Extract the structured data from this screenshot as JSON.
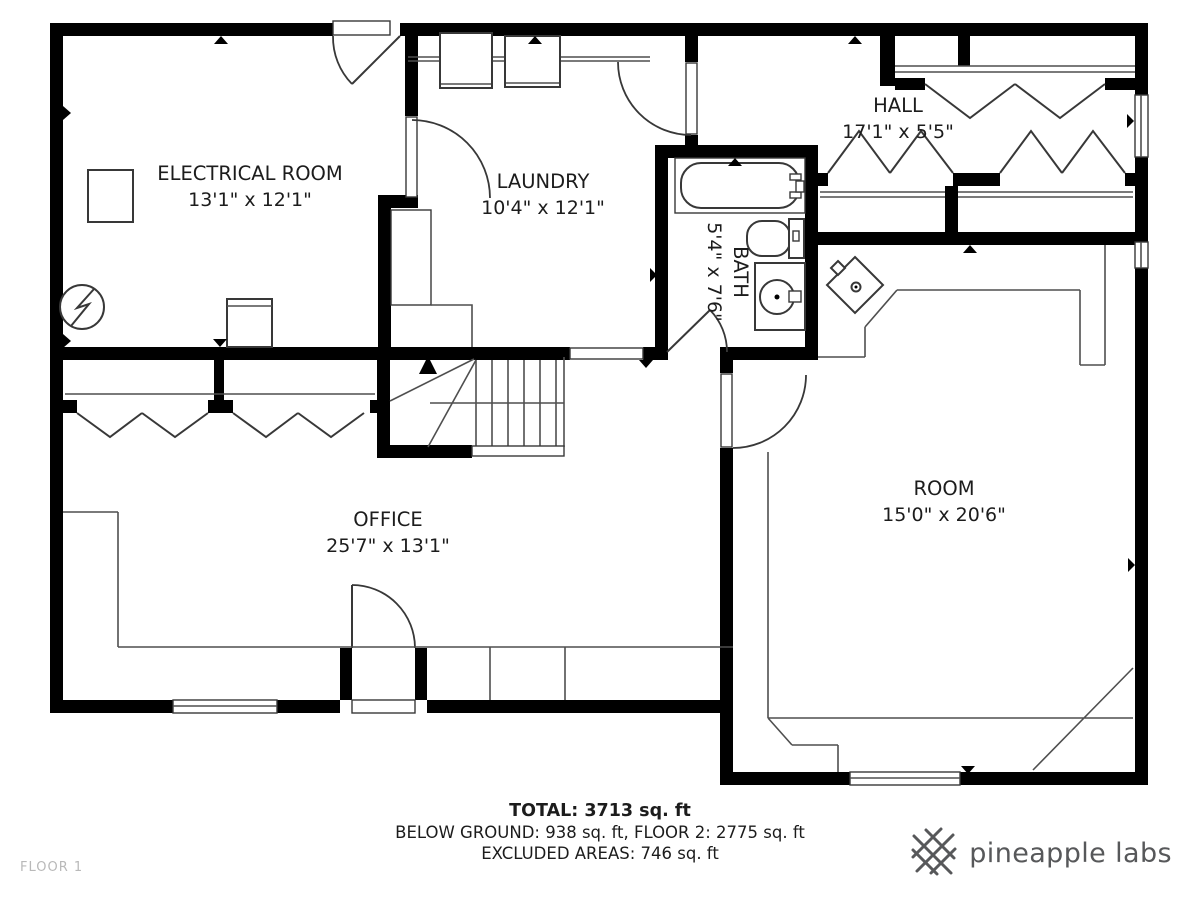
{
  "page": {
    "floor_label": "FLOOR 1"
  },
  "rooms": {
    "electrical": {
      "name": "ELECTRICAL ROOM",
      "dims": "13'1\" x 12'1\""
    },
    "laundry": {
      "name": "LAUNDRY",
      "dims": "10'4\" x 12'1\""
    },
    "bath": {
      "name": "BATH",
      "dims": "5'4\" x 7'6\""
    },
    "hall": {
      "name": "HALL",
      "dims": "17'1\" x 5'5\""
    },
    "office": {
      "name": "OFFICE",
      "dims": "25'7\" x 13'1\""
    },
    "room": {
      "name": "ROOM",
      "dims": "15'0\" x 20'6\""
    }
  },
  "summary": {
    "total": "TOTAL: 3713 sq. ft",
    "breakdown": "BELOW GROUND: 938 sq. ft, FLOOR 2: 2775 sq. ft",
    "excluded": "EXCLUDED AREAS: 746 sq. ft"
  },
  "branding": {
    "logo_text": "pineapple labs"
  },
  "colors": {
    "wall": "#000000",
    "line": "#383838",
    "thin": "#4f4f4f",
    "text": "#1c1c1c",
    "muted": "#b9b9b9",
    "brand": "#57585a"
  }
}
